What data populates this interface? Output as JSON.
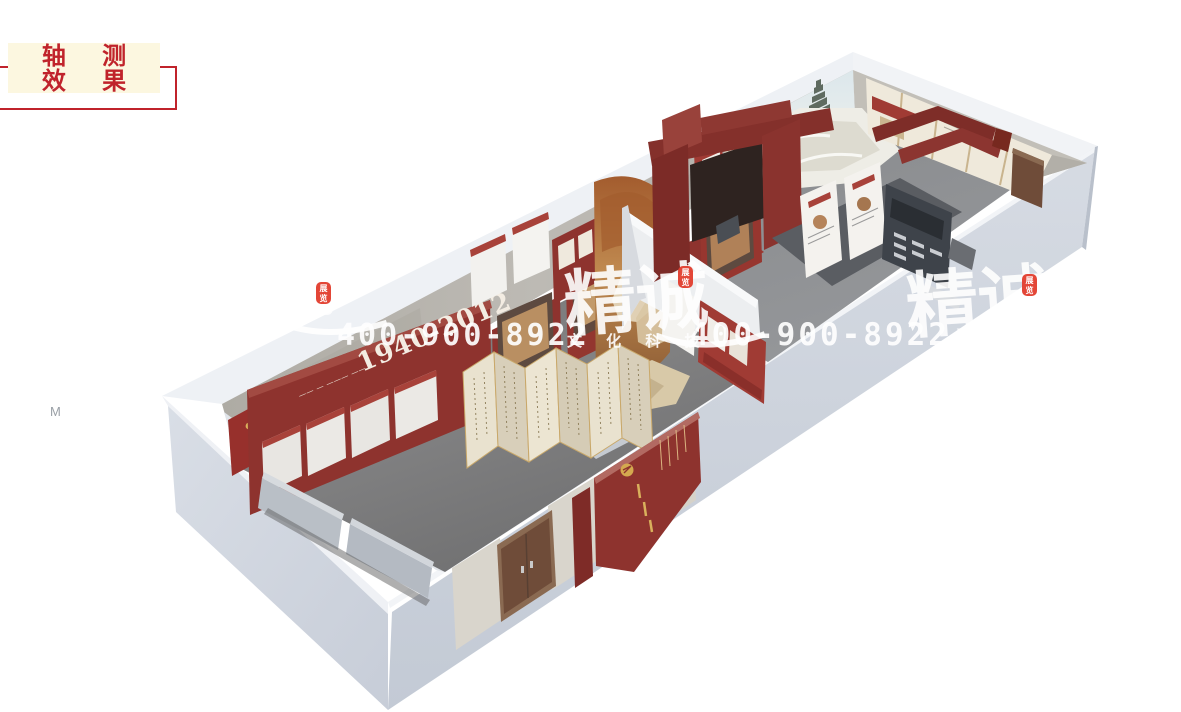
{
  "badge": {
    "line1": "轴 测",
    "line2": "效 果",
    "text_color": "#c0232b",
    "bg": "#fcf7e0",
    "border": "#c0232b"
  },
  "stray_label": {
    "text": "M"
  },
  "watermark": {
    "brand": "精诚",
    "tagline": "文 化 科 技",
    "phone": "400-900-8922",
    "seal": {
      "c1": "展",
      "c2": "览"
    },
    "seal_color": "#e23c2c",
    "ink_color": "#ffffff"
  },
  "scene": {
    "timeline_labels": [
      "1940-2012",
      "2014"
    ],
    "palette": {
      "outer_wall": "#cdd3dd",
      "outer_wall_light": "#dfe3ea",
      "top_strip": "#eef1f5",
      "inner_concrete": "#b6b3ae",
      "floor_room1": "#7d7d7e",
      "floor_room2": "#8e9094",
      "exhibit_red": "#8e332e",
      "deep_red": "#7e2b27",
      "gateway_red": "#84302b",
      "door_brown": "#6f4c39",
      "screen_cream": "#e9e2cf",
      "screen_cream_dark": "#d8cfba",
      "gold": "#d4a94f",
      "kiosk_dark": "#3e434a",
      "panel_cream": "#efe9db",
      "mural_sepia": "#b97f4a",
      "carpet_red": "#9c3a33"
    }
  }
}
